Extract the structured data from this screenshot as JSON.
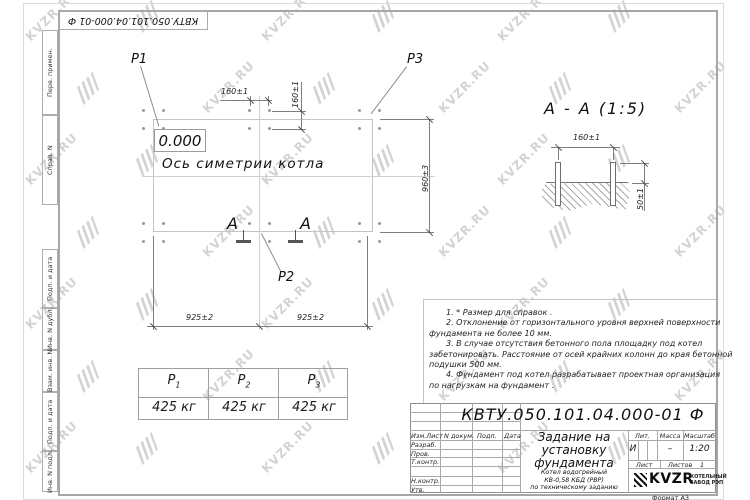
{
  "watermark": {
    "text": "KVZR.RU"
  },
  "stamp_top": {
    "doc_number": "КВТУ.050.101.04.000-01  Ф"
  },
  "sidebar": {
    "labels": [
      "Перв. примен.",
      "Справ. N",
      "Подп. и дата",
      "Инв. N дубл.",
      "Взам. инв. N",
      "Подп. и дата",
      "Инв. N подл."
    ]
  },
  "plan": {
    "elevation": "0.000",
    "axis_label": "Ось симетрии котла",
    "point_labels": {
      "p1": "P1",
      "p2": "P2",
      "p3": "P3"
    },
    "section_letter_left": "А",
    "section_letter_right": "А",
    "dims": {
      "bolt_spacing_h": "160±1",
      "bolt_spacing_v": "160±1",
      "height_right": "960±3",
      "bottom_left": "925±2",
      "bottom_right": "925±2"
    }
  },
  "section_view": {
    "title": "А - А (1:5)",
    "dims": {
      "bolt_spacing": "160±1",
      "protrusion": "50±1"
    }
  },
  "notes": {
    "lines": [
      "1. * Размер для справок .",
      "2. Отклонение от горизонтального уровня верхней поверхности",
      "фундамента не более 10 мм.",
      "3. В случае отсутствия бетонного пола площадку под котел",
      "забетонировать. Расстояние от осей крайних колонн до края бетонной",
      "подушки 500 мм.",
      "4. Фундамент под котел разрабатывает проектная организация",
      "по нагрузкам на фундамент ."
    ]
  },
  "load_table": {
    "headers": [
      {
        "label": "P",
        "sub": "1"
      },
      {
        "label": "P",
        "sub": "2"
      },
      {
        "label": "P",
        "sub": "3"
      }
    ],
    "values": [
      "425 кг",
      "425 кг",
      "425 кг"
    ]
  },
  "title_block": {
    "doc_number": "КВТУ.050.101.04.000-01  Ф",
    "title_lines": [
      "Задание на",
      "установку",
      "фундамента"
    ],
    "subtitle_lines": [
      "Котел водогрейный",
      "КВ-0,58 КБД (РВР)",
      "по техническому заданию"
    ],
    "header_cols": [
      "Изм.Лист",
      "N докум.",
      "Подп.",
      "Дата"
    ],
    "rows": [
      "Разраб.",
      "Пров.",
      "Т.контр.",
      "Н.контр.",
      "Утв."
    ],
    "lit_header": [
      "Лит.",
      "Масса",
      "Масштаб"
    ],
    "lit_values": [
      "И",
      "–",
      "1:20"
    ],
    "sheet_label": "Лист",
    "sheets_label": "Листов",
    "sheets_value": "1",
    "company": {
      "logo": "KVZR",
      "name_lines": [
        "КОТЕЛЬНЫЙ",
        "ЗАВОД РЭП"
      ]
    },
    "format": "Формат А3"
  }
}
